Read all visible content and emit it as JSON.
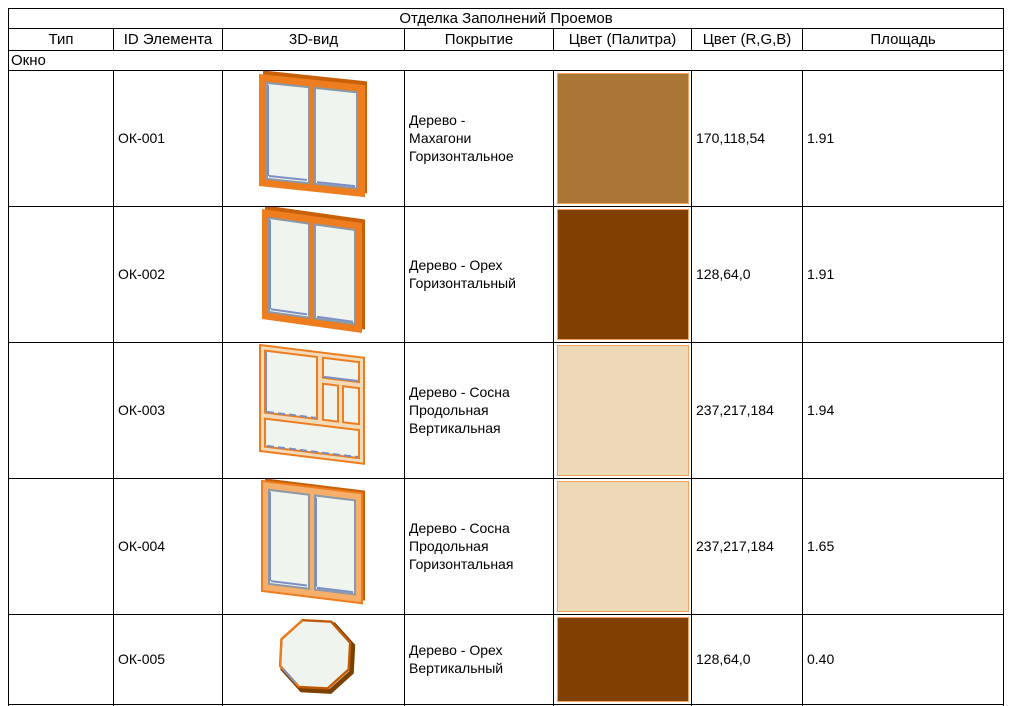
{
  "table": {
    "title": "Отделка Заполнений Проемов",
    "columns": [
      "Тип",
      "ID Элемента",
      "3D-вид",
      "Покрытие",
      "Цвет (Палитра)",
      "Цвет (R,G,B)",
      "Площадь"
    ],
    "section": "Окно"
  },
  "rows": [
    {
      "id": "ОК-001",
      "view_icon": "window-double-casement",
      "coating": "Дерево -\nМахагони\nГоризонтальное",
      "palette_hex": "#AA7636",
      "rgb": "170,118,54",
      "area": "1.91"
    },
    {
      "id": "ОК-002",
      "view_icon": "window-double-casement",
      "coating": "Дерево - Орех\nГоризонтальный",
      "palette_hex": "#804000",
      "rgb": "128,64,0",
      "area": "1.91"
    },
    {
      "id": "ОК-003",
      "view_icon": "window-multi-pane",
      "coating": "Дерево - Сосна\nПродольная\nВертикальная",
      "palette_hex": "#EDD9B8",
      "rgb": "237,217,184",
      "area": "1.94"
    },
    {
      "id": "ОК-004",
      "view_icon": "window-double-casement",
      "coating": "Дерево - Сосна\nПродольная\nГоризонтальная",
      "palette_hex": "#EDD9B8",
      "rgb": "237,217,184",
      "area": "1.65"
    },
    {
      "id": "ОК-005",
      "view_icon": "window-octagonal",
      "coating": "Дерево - Орех\nВертикальный",
      "palette_hex": "#804000",
      "rgb": "128,64,0",
      "area": "0.40"
    }
  ],
  "colors": {
    "swatch_border": "#F2A263",
    "frame_orange": "#ED7D1F",
    "dark_walnut": "#7B3F00"
  }
}
